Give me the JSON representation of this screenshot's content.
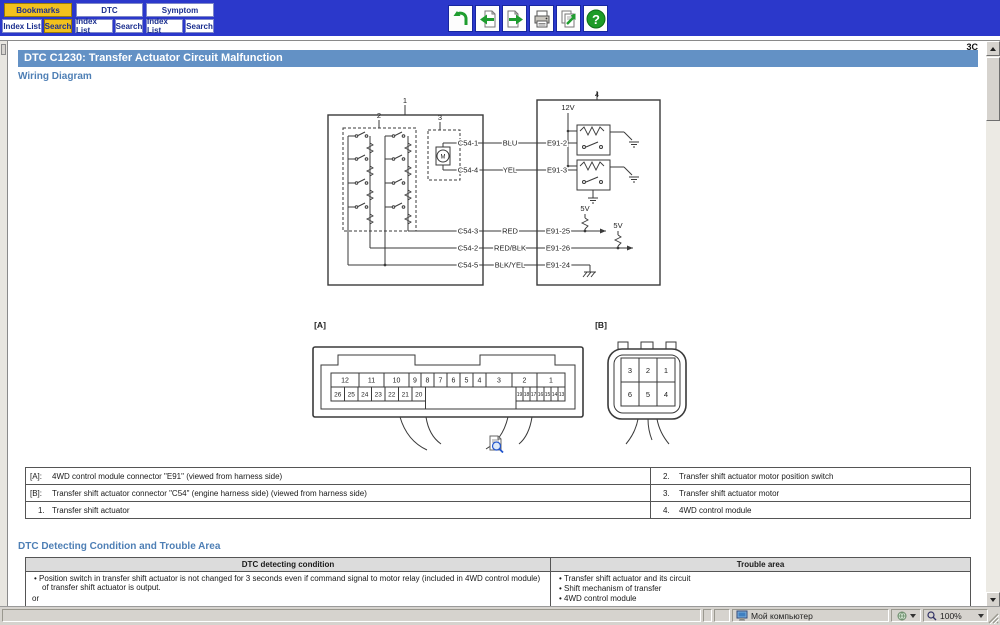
{
  "header": {
    "tabs": [
      {
        "label": "Bookmarks",
        "active": true
      },
      {
        "label": "DTC",
        "active": false
      },
      {
        "label": "Symptom",
        "active": false
      }
    ],
    "buttons": [
      {
        "label": "Index List",
        "active": false
      },
      {
        "label": "Search",
        "active": true
      },
      {
        "label": "Index List",
        "active": false
      },
      {
        "label": "Search",
        "active": false
      },
      {
        "label": "Index List",
        "active": false
      },
      {
        "label": "Search",
        "active": false
      }
    ],
    "toolbar_icons": [
      "undo",
      "previous-page",
      "next-page",
      "print",
      "export",
      "help"
    ],
    "help_glyph": "?"
  },
  "page": {
    "corner_label": "3C",
    "title": "DTC C1230: Transfer Actuator Circuit Malfunction",
    "section_wiring": "Wiring Diagram",
    "section_dtc": "DTC Detecting Condition and Trouble Area"
  },
  "diagram": {
    "blocks": {
      "b1": "1",
      "b2": "2",
      "b3": "3",
      "b4": "4"
    },
    "motor": "M",
    "v12": "12V",
    "v5a": "5V",
    "v5b": "5V",
    "rows": [
      {
        "pin": "C54-1",
        "wire": "BLU",
        "e91": "E91-2"
      },
      {
        "pin": "C54-4",
        "wire": "YEL",
        "e91": "E91-3"
      },
      {
        "pin": "C54-3",
        "wire": "RED",
        "e91": "E91-25"
      },
      {
        "pin": "C54-2",
        "wire": "RED/BLK",
        "e91": "E91-26"
      },
      {
        "pin": "C54-5",
        "wire": "BLK/YEL",
        "e91": "E91-24"
      }
    ],
    "conn_a": {
      "label": "[A]",
      "top": [
        "12",
        "11",
        "10",
        "9",
        "8",
        "7",
        "6",
        "5",
        "4",
        "3",
        "2",
        "1"
      ],
      "bl": [
        "26",
        "25",
        "24",
        "23",
        "22",
        "21",
        "20"
      ],
      "br": [
        "19",
        "18",
        "17",
        "16",
        "15",
        "14",
        "13"
      ]
    },
    "conn_b": {
      "label": "[B]",
      "top": [
        "3",
        "2",
        "1"
      ],
      "bottom": [
        "6",
        "5",
        "4"
      ]
    }
  },
  "legend_table": {
    "rows": [
      {
        "l_label": "[A]:",
        "l_text": "4WD control module connector \"E91\" (viewed from harness side)",
        "r_label": "2.",
        "r_text": "Transfer shift actuator motor position switch"
      },
      {
        "l_label": "[B]:",
        "l_text": "Transfer shift actuator connector \"C54\" (engine harness side) (viewed from harness side)",
        "r_label": "3.",
        "r_text": "Transfer shift actuator motor"
      },
      {
        "l_label": "1.",
        "l_text": "Transfer shift actuator",
        "r_label": "4.",
        "r_text": "4WD control module"
      }
    ]
  },
  "dtc_table": {
    "headers": [
      "DTC detecting condition",
      "Trouble area"
    ],
    "condition_items": [
      "Position switch in transfer shift actuator is not changed for 3 seconds even if command signal to motor relay (included in 4WD control module) of transfer shift actuator is output.",
      "or",
      "Monitor signal from motor relay (included in 4WD control module) of transfer shift actuator is inconsistent with command signal to motor"
    ],
    "trouble_items": [
      "Transfer shift actuator and its circuit",
      "Shift mechanism of transfer",
      "4WD control module"
    ]
  },
  "status_bar": {
    "location": "Мой компьютер",
    "zoom": "100%"
  }
}
